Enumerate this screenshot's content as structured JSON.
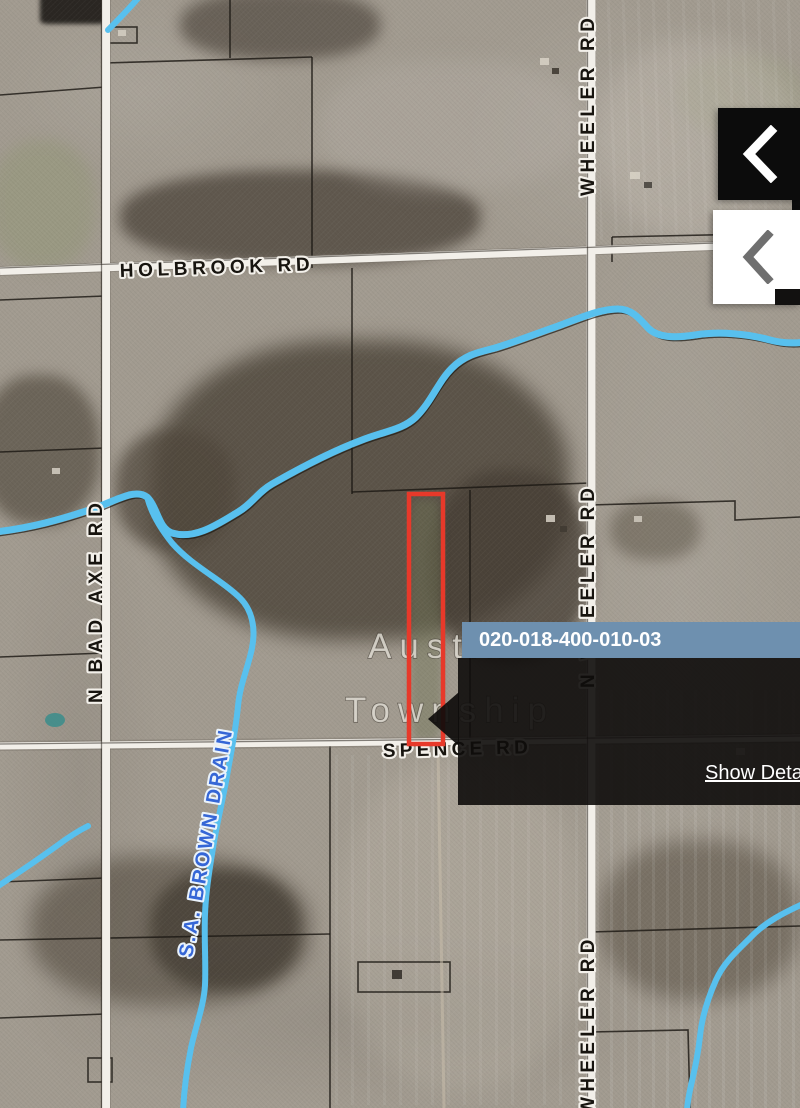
{
  "map": {
    "township_label": {
      "line1": "Austin",
      "line2": "Township"
    },
    "roads": {
      "holbrook": "HOLBROOK RD",
      "wheeler_top": "WHEELER RD",
      "wheeler_middle": "N WHEELER RD",
      "wheeler_bottom": "N WHEELER RD",
      "bad_axe": "N BAD AXE RD",
      "spence": "SPENCE RD"
    },
    "water": {
      "drain_label": "S.A. BROWN DRAIN"
    },
    "colors": {
      "water": "#58c0ee",
      "drain_text": "#3566d6",
      "selection_outline": "#e7392a",
      "popup_header": "#6e90af",
      "road": "#f2efe9"
    }
  },
  "popup": {
    "title": "020-018-400-010-03",
    "link": "Show Details"
  },
  "side_controls": {
    "collapse_dark": {
      "icon": "chevron-left"
    },
    "collapse_light": {
      "icon": "chevron-left"
    }
  }
}
